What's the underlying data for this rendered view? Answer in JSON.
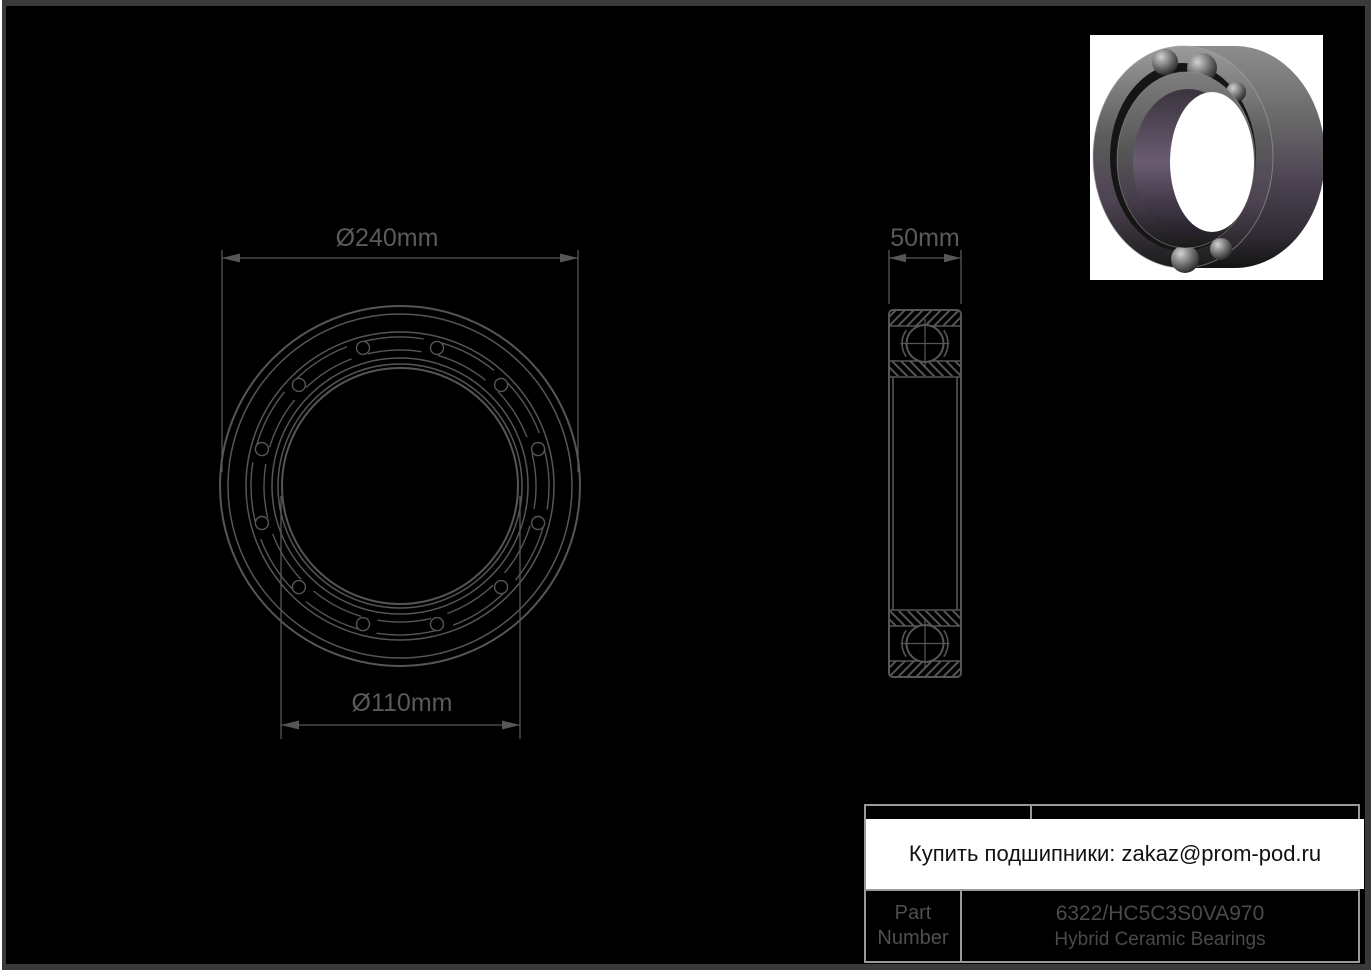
{
  "colors": {
    "background": "#000000",
    "frame": "#3a3a3a",
    "edge_line": "#ffffff",
    "drawing_line": "#565656",
    "dimension_text": "#5a5a5a",
    "table_border": "#9a9a9a",
    "table_text": "#4f4f4f",
    "banner_bg": "#ffffff",
    "banner_text": "#111111",
    "render_bg": "#ffffff"
  },
  "front_view": {
    "od_label": "Ø240mm",
    "bore_label": "Ø110mm"
  },
  "side_view": {
    "width_label": "50mm"
  },
  "banner": {
    "text": "Купить подшипники: zakaz@prom-pod.ru"
  },
  "part_table": {
    "label_line1": "Part",
    "label_line2": "Number",
    "part_number": "6322/HC5C3S0VA970",
    "series": "Hybrid Ceramic Bearings"
  }
}
